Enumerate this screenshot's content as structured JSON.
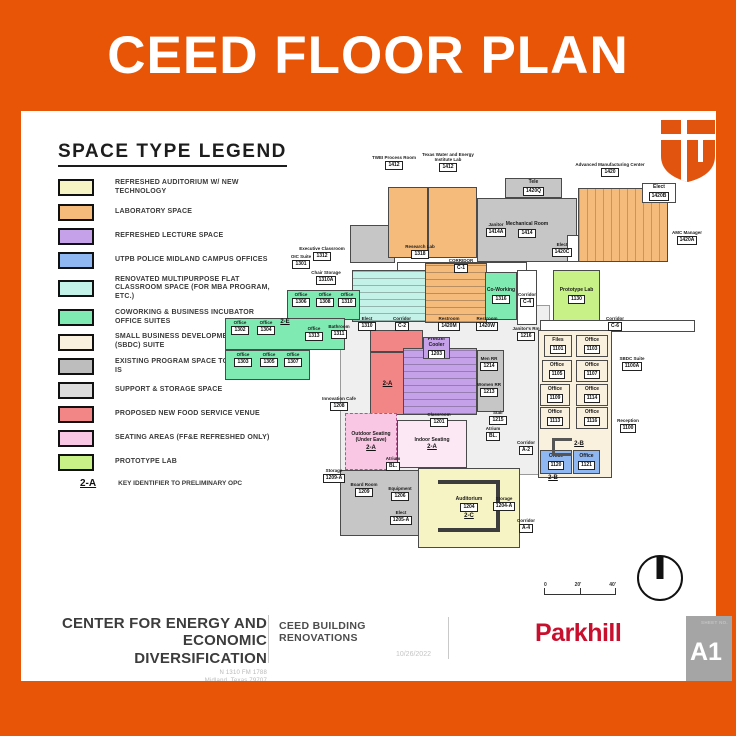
{
  "banner": {
    "title": "CEED FLOOR PLAN"
  },
  "brand": {
    "orange": "#E95506",
    "parkhill_red": "#C8102E",
    "sheet_gray": "#a5a5a5"
  },
  "legend": {
    "title": "SPACE TYPE LEGEND",
    "items": [
      {
        "label": "REFRESHED AUDITORIUM W/ NEW TECHNOLOGY",
        "color": "#F6F3C4"
      },
      {
        "label": "LABORATORY SPACE",
        "color": "#F5BB7B"
      },
      {
        "label": "REFRESHED LECTURE SPACE",
        "color": "#C5A1EA"
      },
      {
        "label": "UTPB POLICE MIDLAND CAMPUS OFFICES",
        "color": "#8FB7F2"
      },
      {
        "label": "RENOVATED MULTIPURPOSE FLAT CLASSROOM SPACE (FOR MBA PROGRAM, ETC.)",
        "color": "#C3F2E8"
      },
      {
        "label": "COWORKING & BUSINESS INCUBATOR OFFICE SUITES",
        "color": "#7FEBB3"
      },
      {
        "label": "SMALL BUSINESS DEVELOPMENT CENTER (SBDC) SUITE",
        "color": "#FAF0DE"
      },
      {
        "label": "EXISTING PROGRAM SPACE TO REMAIN AS-IS",
        "color": "#BDBDBD"
      },
      {
        "label": "SUPPORT & STORAGE SPACE",
        "color": "#DCDCDC"
      },
      {
        "label": "PROPOSED NEW FOOD SERVICE VENUE",
        "color": "#F28585"
      },
      {
        "label": "SEATING AREAS (FF&E REFRESHED ONLY)",
        "color": "#F9C7E4"
      },
      {
        "label": "PROTOTYPE LAB",
        "color": "#C8F287"
      }
    ],
    "key_note": {
      "key": "2-A",
      "label": "KEY IDENTIFIER TO PRELIMINARY OPC"
    }
  },
  "floorplan": {
    "colors": {
      "auditorium": "#F6F3C4",
      "lab": "#F5BB7B",
      "lecture": "#C5A1EA",
      "police": "#8FB7F2",
      "classroom": "#C3F2E8",
      "coworking": "#7FEBB3",
      "sbdc": "#FAF0DE",
      "existing": "#C6C6C6",
      "storage": "#DCDCDC",
      "food": "#F28585",
      "seating": "#F9C7E4",
      "seatlight": "#FCE7F4",
      "prototype": "#C8F287",
      "white": "#FFFFFF",
      "hall": "#EFEFEF"
    },
    "rooms": [
      {
        "id": "circulation-hall",
        "c": "hall",
        "x": 118,
        "y": 155,
        "w": 210,
        "h": 170
      },
      {
        "id": "stair-block",
        "c": "existing",
        "x": 128,
        "y": 75,
        "w": 45,
        "h": 38
      },
      {
        "id": "lower-gray-wing",
        "c": "existing",
        "x": 118,
        "y": 320,
        "w": 95,
        "h": 66
      },
      {
        "id": "twei-process-room",
        "c": "lab",
        "x": 166,
        "y": 37,
        "w": 40,
        "h": 71
      },
      {
        "id": "twei-lab",
        "c": "lab",
        "x": 206,
        "y": 37,
        "w": 49,
        "h": 71
      },
      {
        "id": "tele-room",
        "c": "existing",
        "x": 283,
        "y": 28,
        "w": 57,
        "h": 20,
        "n": "Tele",
        "t": "1420Q"
      },
      {
        "id": "mechanical-room",
        "c": "existing",
        "x": 255,
        "y": 48,
        "w": 100,
        "h": 64,
        "n": "Mechanical Room",
        "t": "1414"
      },
      {
        "id": "ird-room",
        "c": "white",
        "x": 345,
        "y": 85,
        "w": 45,
        "h": 27,
        "n": "IRD",
        "t": "1417"
      },
      {
        "id": "advanced-manufacturing-center",
        "c": "lab",
        "x": 356,
        "y": 38,
        "w": 90,
        "h": 74,
        "pat": "cols"
      },
      {
        "id": "amc-elect",
        "c": "white",
        "x": 420,
        "y": 33,
        "w": 34,
        "h": 20,
        "n": "Elect",
        "t": "1420B"
      },
      {
        "id": "corridor-top",
        "c": "white",
        "x": 175,
        "y": 112,
        "w": 130,
        "h": 12
      },
      {
        "id": "executive-classroom",
        "c": "classroom",
        "x": 130,
        "y": 120,
        "w": 75,
        "h": 52,
        "pat": "rows"
      },
      {
        "id": "research-lab",
        "c": "lab",
        "x": 203,
        "y": 113,
        "w": 62,
        "h": 60,
        "pat": "rows"
      },
      {
        "id": "coworking-lounge",
        "c": "coworking",
        "x": 263,
        "y": 122,
        "w": 32,
        "h": 48,
        "n": "Co-Working",
        "t": "1316"
      },
      {
        "id": "corridor-mid",
        "c": "white",
        "x": 295,
        "y": 120,
        "w": 20,
        "h": 55
      },
      {
        "id": "prototype-lab",
        "c": "prototype",
        "x": 331,
        "y": 120,
        "w": 47,
        "h": 52,
        "n": "Prototype Lab",
        "t": "1130"
      },
      {
        "id": "corridor-right",
        "c": "white",
        "x": 318,
        "y": 170,
        "w": 155,
        "h": 12
      },
      {
        "id": "coworking-suite-a",
        "c": "coworking",
        "x": 65,
        "y": 140,
        "w": 73,
        "h": 30
      },
      {
        "id": "coworking-suite-b",
        "c": "coworking",
        "x": 3,
        "y": 168,
        "w": 120,
        "h": 32
      },
      {
        "id": "coworking-suite-c",
        "c": "coworking",
        "x": 3,
        "y": 200,
        "w": 85,
        "h": 30
      },
      {
        "id": "food-service-upper",
        "c": "food",
        "x": 148,
        "y": 180,
        "w": 53,
        "h": 22
      },
      {
        "id": "food-service-kitchen",
        "c": "food",
        "x": 148,
        "y": 202,
        "w": 35,
        "h": 63,
        "k": "2-A"
      },
      {
        "id": "lecture-classroom",
        "c": "lecture",
        "x": 181,
        "y": 198,
        "w": 74,
        "h": 67,
        "pat": "rows"
      },
      {
        "id": "freezer-cooler",
        "c": "lecture",
        "x": 201,
        "y": 187,
        "w": 27,
        "h": 22,
        "n": "Freezer Cooler",
        "t": "1203"
      },
      {
        "id": "restroom-block",
        "c": "existing",
        "x": 255,
        "y": 200,
        "w": 27,
        "h": 62
      },
      {
        "id": "outdoor-seating",
        "c": "seating",
        "x": 123,
        "y": 263,
        "w": 52,
        "h": 57,
        "dash": true,
        "n": "Outdoor Seating (Under Eave)",
        "k": "2-A"
      },
      {
        "id": "indoor-seating",
        "c": "seatlight",
        "x": 175,
        "y": 270,
        "w": 70,
        "h": 48,
        "n": "Indoor Seating",
        "k": "2-A"
      },
      {
        "id": "auditorium",
        "c": "auditorium",
        "x": 196,
        "y": 318,
        "w": 102,
        "h": 80,
        "n": "Auditorium",
        "t": "1204",
        "k": "2-C"
      },
      {
        "id": "sbdc-suite",
        "c": "sbdc",
        "x": 316,
        "y": 180,
        "w": 74,
        "h": 148
      },
      {
        "id": "files-1101",
        "c": "sbdc",
        "x": 322,
        "y": 185,
        "w": 28,
        "h": 22,
        "n": "Files",
        "t": "1101"
      },
      {
        "id": "office-1103",
        "c": "sbdc",
        "x": 354,
        "y": 185,
        "w": 32,
        "h": 22,
        "n": "Office",
        "t": "1103"
      },
      {
        "id": "office-1105",
        "c": "sbdc",
        "x": 320,
        "y": 210,
        "w": 30,
        "h": 22,
        "n": "Office",
        "t": "1105"
      },
      {
        "id": "office-1107",
        "c": "sbdc",
        "x": 354,
        "y": 210,
        "w": 32,
        "h": 22,
        "n": "Office",
        "t": "1107"
      },
      {
        "id": "office-1109",
        "c": "sbdc",
        "x": 318,
        "y": 234,
        "w": 30,
        "h": 22,
        "n": "Office",
        "t": "1109"
      },
      {
        "id": "office-1114",
        "c": "sbdc",
        "x": 354,
        "y": 234,
        "w": 32,
        "h": 22,
        "n": "Office",
        "t": "1114"
      },
      {
        "id": "office-1113",
        "c": "sbdc",
        "x": 318,
        "y": 257,
        "w": 30,
        "h": 22,
        "n": "Office",
        "t": "1113"
      },
      {
        "id": "office-1116",
        "c": "sbdc",
        "x": 354,
        "y": 257,
        "w": 32,
        "h": 22,
        "n": "Office",
        "t": "1116"
      },
      {
        "id": "police-office-1120",
        "c": "police",
        "x": 318,
        "y": 300,
        "w": 32,
        "h": 24,
        "n": "Office",
        "t": "1120"
      },
      {
        "id": "police-office-1121",
        "c": "police",
        "x": 351,
        "y": 300,
        "w": 27,
        "h": 24,
        "n": "Office",
        "t": "1121"
      }
    ],
    "decos": [
      {
        "id": "auditorium-table",
        "kind": "utable",
        "x": 216,
        "y": 330,
        "w": 62,
        "h": 52
      },
      {
        "id": "reception-desk",
        "kind": "cdesk",
        "x": 330,
        "y": 288,
        "w": 20,
        "h": 18
      }
    ],
    "labels": [
      {
        "id": "twei-process-label",
        "txt": "TWEI Process Room",
        "tag": "1412",
        "x": 150,
        "y": 5,
        "w": 44
      },
      {
        "id": "twei-lab-label",
        "txt": "Texas Water and Energy Institute Lab",
        "tag": "1412",
        "x": 200,
        "y": 2,
        "w": 52
      },
      {
        "id": "amc-label",
        "txt": "Advanced Manufacturing Center",
        "tag": "1420",
        "x": 352,
        "y": 12,
        "w": 72
      },
      {
        "id": "amc-manager-label",
        "txt": "AMC Manager",
        "tag": "1420A",
        "x": 444,
        "y": 80,
        "w": 42
      },
      {
        "id": "amc-elect-left-label",
        "txt": "Elect",
        "tag": "1420C",
        "x": 328,
        "y": 92,
        "w": 24
      },
      {
        "id": "janitor-mech-label",
        "txt": "Janitor",
        "tag": "1414A",
        "x": 260,
        "y": 72,
        "w": 28
      },
      {
        "id": "corridor-top-label",
        "txt": "CORRIDOR",
        "tag": "C-1",
        "x": 218,
        "y": 108,
        "w": 42
      },
      {
        "id": "executive-classroom-label",
        "txt": "Executive Classroom",
        "tag": "1312",
        "x": 76,
        "y": 96,
        "w": 48
      },
      {
        "id": "research-lab-label",
        "txt": "Research Lab",
        "tag": "1318",
        "x": 178,
        "y": 94,
        "w": 40
      },
      {
        "id": "oic-suite-label",
        "txt": "OIC Suite",
        "tag": "1301",
        "x": 64,
        "y": 104,
        "w": 30
      },
      {
        "id": "chair-storage-label",
        "txt": "Chair Storage",
        "tag": "1310A",
        "x": 86,
        "y": 120,
        "w": 36
      },
      {
        "id": "corridor-mid-label",
        "txt": "Corridor",
        "tag": "C-4",
        "x": 289,
        "y": 142,
        "w": 32
      },
      {
        "id": "corridor-right-label",
        "txt": "Corridor",
        "tag": "C-6",
        "x": 378,
        "y": 166,
        "w": 30
      },
      {
        "id": "office-1306-label",
        "txt": "Office",
        "tag": "1306",
        "x": 68,
        "y": 142,
        "w": 22
      },
      {
        "id": "office-1308-label",
        "txt": "Office",
        "tag": "1308",
        "x": 92,
        "y": 142,
        "w": 22
      },
      {
        "id": "office-1310-label",
        "txt": "Office",
        "tag": "1310",
        "x": 114,
        "y": 142,
        "w": 22
      },
      {
        "id": "office-1302-label",
        "txt": "Office",
        "tag": "1302",
        "x": 6,
        "y": 170,
        "w": 24
      },
      {
        "id": "office-1304-label",
        "txt": "Office",
        "tag": "1304",
        "x": 32,
        "y": 170,
        "w": 24
      },
      {
        "id": "office-1313-label",
        "txt": "Office",
        "tag": "1313",
        "x": 80,
        "y": 176,
        "w": 24
      },
      {
        "id": "bathroom-1311-label",
        "txt": "Bathroom",
        "tag": "1311",
        "x": 104,
        "y": 174,
        "w": 26
      },
      {
        "id": "office-1303-label",
        "txt": "Office",
        "tag": "1303",
        "x": 10,
        "y": 202,
        "w": 22
      },
      {
        "id": "office-1305-label",
        "txt": "Office",
        "tag": "1305",
        "x": 36,
        "y": 202,
        "w": 22
      },
      {
        "id": "office-1307-label",
        "txt": "Office",
        "tag": "1307",
        "x": 60,
        "y": 202,
        "w": 22
      },
      {
        "id": "key-2e-label",
        "key": "2-E",
        "x": 56,
        "y": 168,
        "w": 14
      },
      {
        "id": "elect-1310-label",
        "txt": "Elect",
        "tag": "1310",
        "x": 134,
        "y": 166,
        "w": 22
      },
      {
        "id": "corridor-c2-label",
        "txt": "Corridor",
        "tag": "C-2",
        "x": 166,
        "y": 166,
        "w": 28
      },
      {
        "id": "restroom-m-label",
        "txt": "Restroom",
        "tag": "1420M",
        "x": 212,
        "y": 166,
        "w": 30
      },
      {
        "id": "restroom-w-label",
        "txt": "Restroom",
        "tag": "1420W",
        "x": 250,
        "y": 166,
        "w": 30
      },
      {
        "id": "janitors-rm-label",
        "txt": "Janitor's Rm",
        "tag": "1216",
        "x": 288,
        "y": 176,
        "w": 32
      },
      {
        "id": "innovation-cafe-label",
        "txt": "Innovation Cafe",
        "tag": "1208",
        "x": 98,
        "y": 246,
        "w": 38
      },
      {
        "id": "classroom-label",
        "txt": "Classroom",
        "tag": "1201",
        "x": 200,
        "y": 262,
        "w": 34
      },
      {
        "id": "men-rr-label",
        "txt": "Men RR",
        "tag": "1214",
        "x": 252,
        "y": 206,
        "w": 30
      },
      {
        "id": "women-rr-label",
        "txt": "Women RR",
        "tag": "1213",
        "x": 252,
        "y": 232,
        "w": 30
      },
      {
        "id": "stair-label",
        "txt": "Stair",
        "tag": "1215",
        "x": 264,
        "y": 260,
        "w": 24
      },
      {
        "id": "atrium-label-1",
        "txt": "Atrium",
        "tag": "BL.",
        "x": 158,
        "y": 306,
        "w": 26
      },
      {
        "id": "atrium-label-2",
        "txt": "Atrium",
        "tag": "BL.",
        "x": 258,
        "y": 276,
        "w": 26
      },
      {
        "id": "board-room-label",
        "txt": "Board Room",
        "tag": "1209",
        "x": 126,
        "y": 332,
        "w": 32
      },
      {
        "id": "equipment-label",
        "txt": "Equipment",
        "tag": "1206",
        "x": 162,
        "y": 336,
        "w": 32
      },
      {
        "id": "elect-1205-label",
        "txt": "Elect",
        "tag": "1205-A",
        "x": 166,
        "y": 360,
        "w": 26
      },
      {
        "id": "storage-1209-label",
        "txt": "Storage",
        "tag": "1209-A",
        "x": 98,
        "y": 318,
        "w": 28
      },
      {
        "id": "storage-1204-label",
        "txt": "Storage",
        "tag": "1204-A",
        "x": 268,
        "y": 346,
        "w": 28
      },
      {
        "id": "sbdc-suite-label",
        "txt": "SBDC Suite",
        "tag": "1100A",
        "x": 392,
        "y": 206,
        "w": 36
      },
      {
        "id": "reception-label",
        "txt": "Reception",
        "tag": "1100",
        "x": 390,
        "y": 268,
        "w": 32
      },
      {
        "id": "corridor-a2-label",
        "txt": "Corridor",
        "tag": "A-2",
        "x": 290,
        "y": 290,
        "w": 28
      },
      {
        "id": "corridor-a4-label",
        "txt": "Corridor",
        "tag": "A-4",
        "x": 290,
        "y": 368,
        "w": 28
      },
      {
        "id": "key-2b-label",
        "key": "2-B",
        "x": 350,
        "y": 290,
        "w": 14
      },
      {
        "id": "key-2b2-label",
        "key": "2-B",
        "x": 324,
        "y": 324,
        "w": 14
      }
    ],
    "scalebar": {
      "ticks": [
        "0",
        "20'",
        "40'"
      ]
    }
  },
  "titleblock": {
    "project_line1": "CENTER FOR ENERGY AND ECONOMIC",
    "project_line2": "DIVERSIFICATION",
    "address1": "N 1310 FM 1788",
    "address2": "Midland, Texas 79707",
    "sheet_title": "CEED BUILDING RENOVATIONS",
    "date": "10/26/2022",
    "firm": "Parkhill",
    "sheet_no_label": "SHEET NO.",
    "sheet_no": "A1"
  }
}
